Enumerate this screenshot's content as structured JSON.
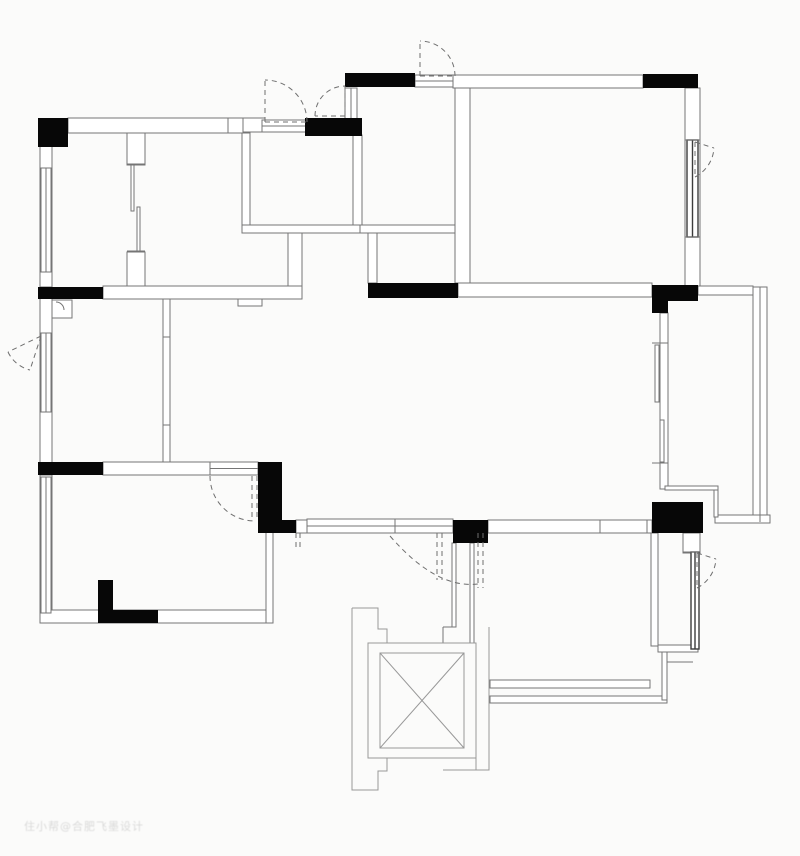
{
  "meta": {
    "title": "apartment-floor-plan",
    "watermark_text": "住小帮@合肥飞墨设计",
    "colors": {
      "background": "#fbfbfa",
      "wall_stroke": "#757575",
      "window_dark": "#3c3c3c",
      "outline": "#989898",
      "black_fill": "#070707",
      "dash": "#6f6f6f"
    }
  },
  "canvas": {
    "w": 800,
    "h": 856
  },
  "chart_data": null,
  "plan": {
    "walls": [
      {
        "x": 68,
        "y": 118,
        "w": 175,
        "h": 15
      },
      {
        "x": 243,
        "y": 118,
        "w": 22,
        "h": 14
      },
      {
        "x": 40,
        "y": 133,
        "w": 12,
        "h": 154
      },
      {
        "x": 40,
        "y": 287,
        "w": 12,
        "h": 188
      },
      {
        "x": 40,
        "y": 475,
        "w": 12,
        "h": 147
      },
      {
        "x": 127,
        "y": 133,
        "w": 18,
        "h": 32
      },
      {
        "x": 127,
        "y": 252,
        "w": 18,
        "h": 35
      },
      {
        "x": 242,
        "y": 133,
        "w": 8,
        "h": 98
      },
      {
        "x": 353,
        "y": 135,
        "w": 9,
        "h": 96
      },
      {
        "x": 242,
        "y": 225,
        "w": 221,
        "h": 8
      },
      {
        "x": 455,
        "y": 88,
        "w": 15,
        "h": 195
      },
      {
        "x": 453,
        "y": 75,
        "w": 190,
        "h": 13
      },
      {
        "x": 685,
        "y": 88,
        "w": 15,
        "h": 198
      },
      {
        "x": 288,
        "y": 233,
        "w": 14,
        "h": 66
      },
      {
        "x": 368,
        "y": 233,
        "w": 9,
        "h": 50
      },
      {
        "x": 103,
        "y": 286,
        "w": 199,
        "h": 13
      },
      {
        "x": 458,
        "y": 283,
        "w": 194,
        "h": 14
      },
      {
        "x": 163,
        "y": 299,
        "w": 7,
        "h": 163
      },
      {
        "x": 103,
        "y": 462,
        "w": 107,
        "h": 13
      },
      {
        "x": 40,
        "y": 610,
        "w": 233,
        "h": 13
      },
      {
        "x": 266,
        "y": 530,
        "w": 7,
        "h": 93
      },
      {
        "x": 296,
        "y": 520,
        "w": 11,
        "h": 13
      },
      {
        "x": 488,
        "y": 520,
        "w": 164,
        "h": 13
      },
      {
        "x": 660,
        "y": 313,
        "w": 8,
        "h": 176
      },
      {
        "x": 698,
        "y": 286,
        "w": 55,
        "h": 9
      },
      {
        "x": 753,
        "y": 287,
        "w": 14,
        "h": 235
      },
      {
        "x": 715,
        "y": 515,
        "w": 55,
        "h": 8
      },
      {
        "x": 714,
        "y": 489,
        "w": 4,
        "h": 28
      },
      {
        "x": 665,
        "y": 486,
        "w": 53,
        "h": 4
      },
      {
        "x": 683,
        "y": 533,
        "w": 17,
        "h": 20
      },
      {
        "x": 651,
        "y": 533,
        "w": 7,
        "h": 113
      },
      {
        "x": 658,
        "y": 645,
        "w": 40,
        "h": 7
      },
      {
        "x": 490,
        "y": 680,
        "w": 160,
        "h": 8
      },
      {
        "x": 490,
        "y": 696,
        "w": 177,
        "h": 7
      },
      {
        "x": 662,
        "y": 652,
        "w": 5,
        "h": 48
      },
      {
        "x": 452,
        "y": 543,
        "w": 4,
        "h": 84
      },
      {
        "x": 470,
        "y": 543,
        "w": 4,
        "h": 100
      },
      {
        "x": 238,
        "y": 299,
        "w": 24,
        "h": 7
      },
      {
        "x": 52,
        "y": 300,
        "w": 20,
        "h": 18
      },
      {
        "x": 131,
        "y": 165,
        "w": 3,
        "h": 46
      },
      {
        "x": 137,
        "y": 207,
        "w": 3,
        "h": 45
      },
      {
        "x": 655,
        "y": 345,
        "w": 4,
        "h": 57
      },
      {
        "x": 660,
        "y": 420,
        "w": 4,
        "h": 42
      }
    ],
    "blacks": [
      {
        "x": 38,
        "y": 118,
        "w": 30,
        "h": 29
      },
      {
        "x": 305,
        "y": 118,
        "w": 57,
        "h": 18
      },
      {
        "x": 345,
        "y": 73,
        "w": 70,
        "h": 14
      },
      {
        "x": 643,
        "y": 74,
        "w": 55,
        "h": 14
      },
      {
        "x": 38,
        "y": 287,
        "w": 65,
        "h": 12
      },
      {
        "x": 368,
        "y": 283,
        "w": 90,
        "h": 15
      },
      {
        "x": 652,
        "y": 285,
        "w": 46,
        "h": 16
      },
      {
        "x": 652,
        "y": 301,
        "w": 16,
        "h": 12
      },
      {
        "x": 38,
        "y": 462,
        "w": 65,
        "h": 13
      },
      {
        "x": 258,
        "y": 462,
        "w": 24,
        "h": 71
      },
      {
        "x": 282,
        "y": 520,
        "w": 14,
        "h": 13
      },
      {
        "x": 453,
        "y": 520,
        "w": 35,
        "h": 23
      },
      {
        "x": 652,
        "y": 502,
        "w": 51,
        "h": 31
      },
      {
        "x": 98,
        "y": 580,
        "w": 15,
        "h": 43
      },
      {
        "x": 98,
        "y": 610,
        "w": 60,
        "h": 13
      },
      {
        "x": 652,
        "y": 520,
        "w": 51,
        "h": 13
      }
    ],
    "windows": [
      {
        "x": 41,
        "y": 168,
        "w": 10,
        "h": 104,
        "dir": "v",
        "dark": false
      },
      {
        "x": 41,
        "y": 333,
        "w": 10,
        "h": 79,
        "dir": "v",
        "dark": false
      },
      {
        "x": 41,
        "y": 477,
        "w": 10,
        "h": 136,
        "dir": "v",
        "dark": false
      },
      {
        "x": 262,
        "y": 120,
        "w": 45,
        "h": 12,
        "dir": "h",
        "dark": false
      },
      {
        "x": 345,
        "y": 88,
        "w": 12,
        "h": 32,
        "dir": "v",
        "dark": false
      },
      {
        "x": 415,
        "y": 75,
        "w": 38,
        "h": 12,
        "dir": "h",
        "dark": false
      },
      {
        "x": 687,
        "y": 140,
        "w": 11,
        "h": 97,
        "dir": "v",
        "dark": true
      },
      {
        "x": 210,
        "y": 462,
        "w": 48,
        "h": 13,
        "dir": "h",
        "dark": false
      },
      {
        "x": 307,
        "y": 519,
        "w": 146,
        "h": 14,
        "dir": "h",
        "dark": false
      },
      {
        "x": 691,
        "y": 552,
        "w": 8,
        "h": 97,
        "dir": "v",
        "dark": true
      }
    ],
    "lines": [
      {
        "x1": 228,
        "y1": 118,
        "x2": 228,
        "y2": 133
      },
      {
        "x1": 600,
        "y1": 520,
        "x2": 600,
        "y2": 533
      },
      {
        "x1": 647,
        "y1": 520,
        "x2": 647,
        "y2": 533
      },
      {
        "x1": 685,
        "y1": 140,
        "x2": 700,
        "y2": 140
      },
      {
        "x1": 685,
        "y1": 237,
        "x2": 700,
        "y2": 237
      },
      {
        "x1": 163,
        "y1": 337,
        "x2": 170,
        "y2": 337
      },
      {
        "x1": 163,
        "y1": 425,
        "x2": 170,
        "y2": 425
      },
      {
        "x1": 360,
        "y1": 225,
        "x2": 360,
        "y2": 233
      },
      {
        "x1": 395,
        "y1": 519,
        "x2": 395,
        "y2": 533
      },
      {
        "x1": 127,
        "y1": 164,
        "x2": 145,
        "y2": 164
      },
      {
        "x1": 127,
        "y1": 251,
        "x2": 145,
        "y2": 251
      },
      {
        "x1": 652,
        "y1": 343,
        "x2": 668,
        "y2": 343
      },
      {
        "x1": 652,
        "y1": 463,
        "x2": 668,
        "y2": 463
      },
      {
        "x1": 667,
        "y1": 662,
        "x2": 693,
        "y2": 662
      },
      {
        "x1": 443,
        "y1": 627,
        "x2": 455,
        "y2": 627
      },
      {
        "x1": 443,
        "y1": 627,
        "x2": 443,
        "y2": 643
      },
      {
        "x1": 683,
        "y1": 552,
        "x2": 700,
        "y2": 552
      },
      {
        "x1": 760,
        "y1": 287,
        "x2": 760,
        "y2": 522
      }
    ],
    "polylines": [
      {
        "pts": "352,608 378,608 378,629 387,629 387,643"
      },
      {
        "pts": "352,608 352,790 378,790 378,771 387,771 387,758"
      },
      {
        "pts": "489,627 489,770 443,770"
      },
      {
        "pts": "476,770 476,758"
      }
    ],
    "dashed": [
      {
        "d": "M307,122 A42,42 0 0 0 265,80",
        "note": "casement-fan"
      },
      {
        "d": "M265,122 L307,122 M265,122 L265,80"
      },
      {
        "d": "M315,116 A30,30 0 0 1 345,86"
      },
      {
        "d": "M345,116 L315,116 M345,116 L345,86"
      },
      {
        "d": "M455,76 A35,35 0 0 0 420,41"
      },
      {
        "d": "M420,76 L455,76 M420,76 L420,41"
      },
      {
        "d": "M695,177 A35,35 0 0 0 714,148"
      },
      {
        "d": "M695,142 L695,177 M695,142 L714,148"
      },
      {
        "d": "M8,352 A33,33 0 0 0 30,370",
        "note": "left-window-fan"
      },
      {
        "d": "M41,336 L8,352 M41,336 L30,370"
      },
      {
        "d": "M697,588 A35,35 0 0 0 716,559"
      },
      {
        "d": "M697,553 L697,588 M697,553 L716,559"
      },
      {
        "d": "M210,476 A45,45 0 0 0 255,521",
        "note": "door-arc"
      },
      {
        "d": "M252,476 L252,517 M257,476 L257,517"
      },
      {
        "d": "M390,536 Q436,589 478,584",
        "note": "living-door-arc"
      },
      {
        "d": "M296,533 L296,551 M300,533 L300,551"
      },
      {
        "d": "M478,533 L478,588 M483,533 L483,588"
      },
      {
        "d": "M437,533 L437,580 M442,533 L442,580"
      }
    ],
    "arcs_small": [
      {
        "d": "M56,302 A8,8 0 0 1 64,310"
      }
    ],
    "elevator": {
      "outer": {
        "x": 368,
        "y": 643,
        "w": 108,
        "h": 115
      },
      "inner": {
        "x": 380,
        "y": 653,
        "w": 84,
        "h": 95
      }
    }
  }
}
